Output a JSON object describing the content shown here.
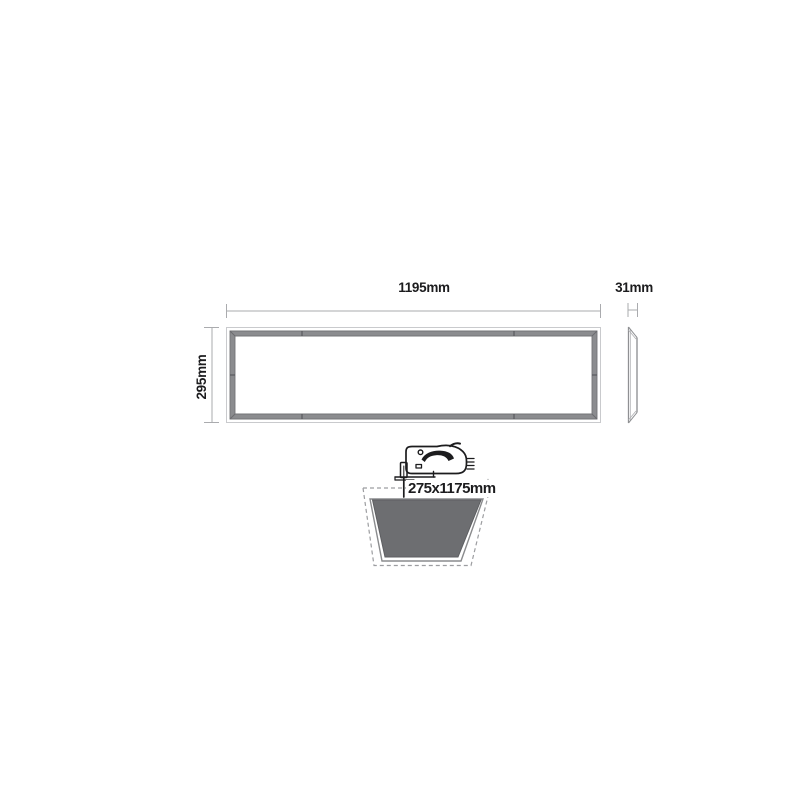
{
  "diagram": {
    "description": "Recessed LED panel light dimension drawing",
    "labels": {
      "front_width": "1195mm",
      "front_height": "295mm",
      "side_depth": "31mm",
      "cutout_size": "275x1175mm"
    },
    "icons": {
      "jigsaw": "jigsaw-icon",
      "insert_arrow": "insert-direction-arrow-icon"
    },
    "colors": {
      "ink": "#1c1c1e",
      "dimension_line": "#aaabae",
      "panel_frame": "#8b8c8f",
      "cutout_fill": "#6d6e71",
      "dashed_outline": "#9c9da0",
      "paper": "#ffffff"
    }
  }
}
